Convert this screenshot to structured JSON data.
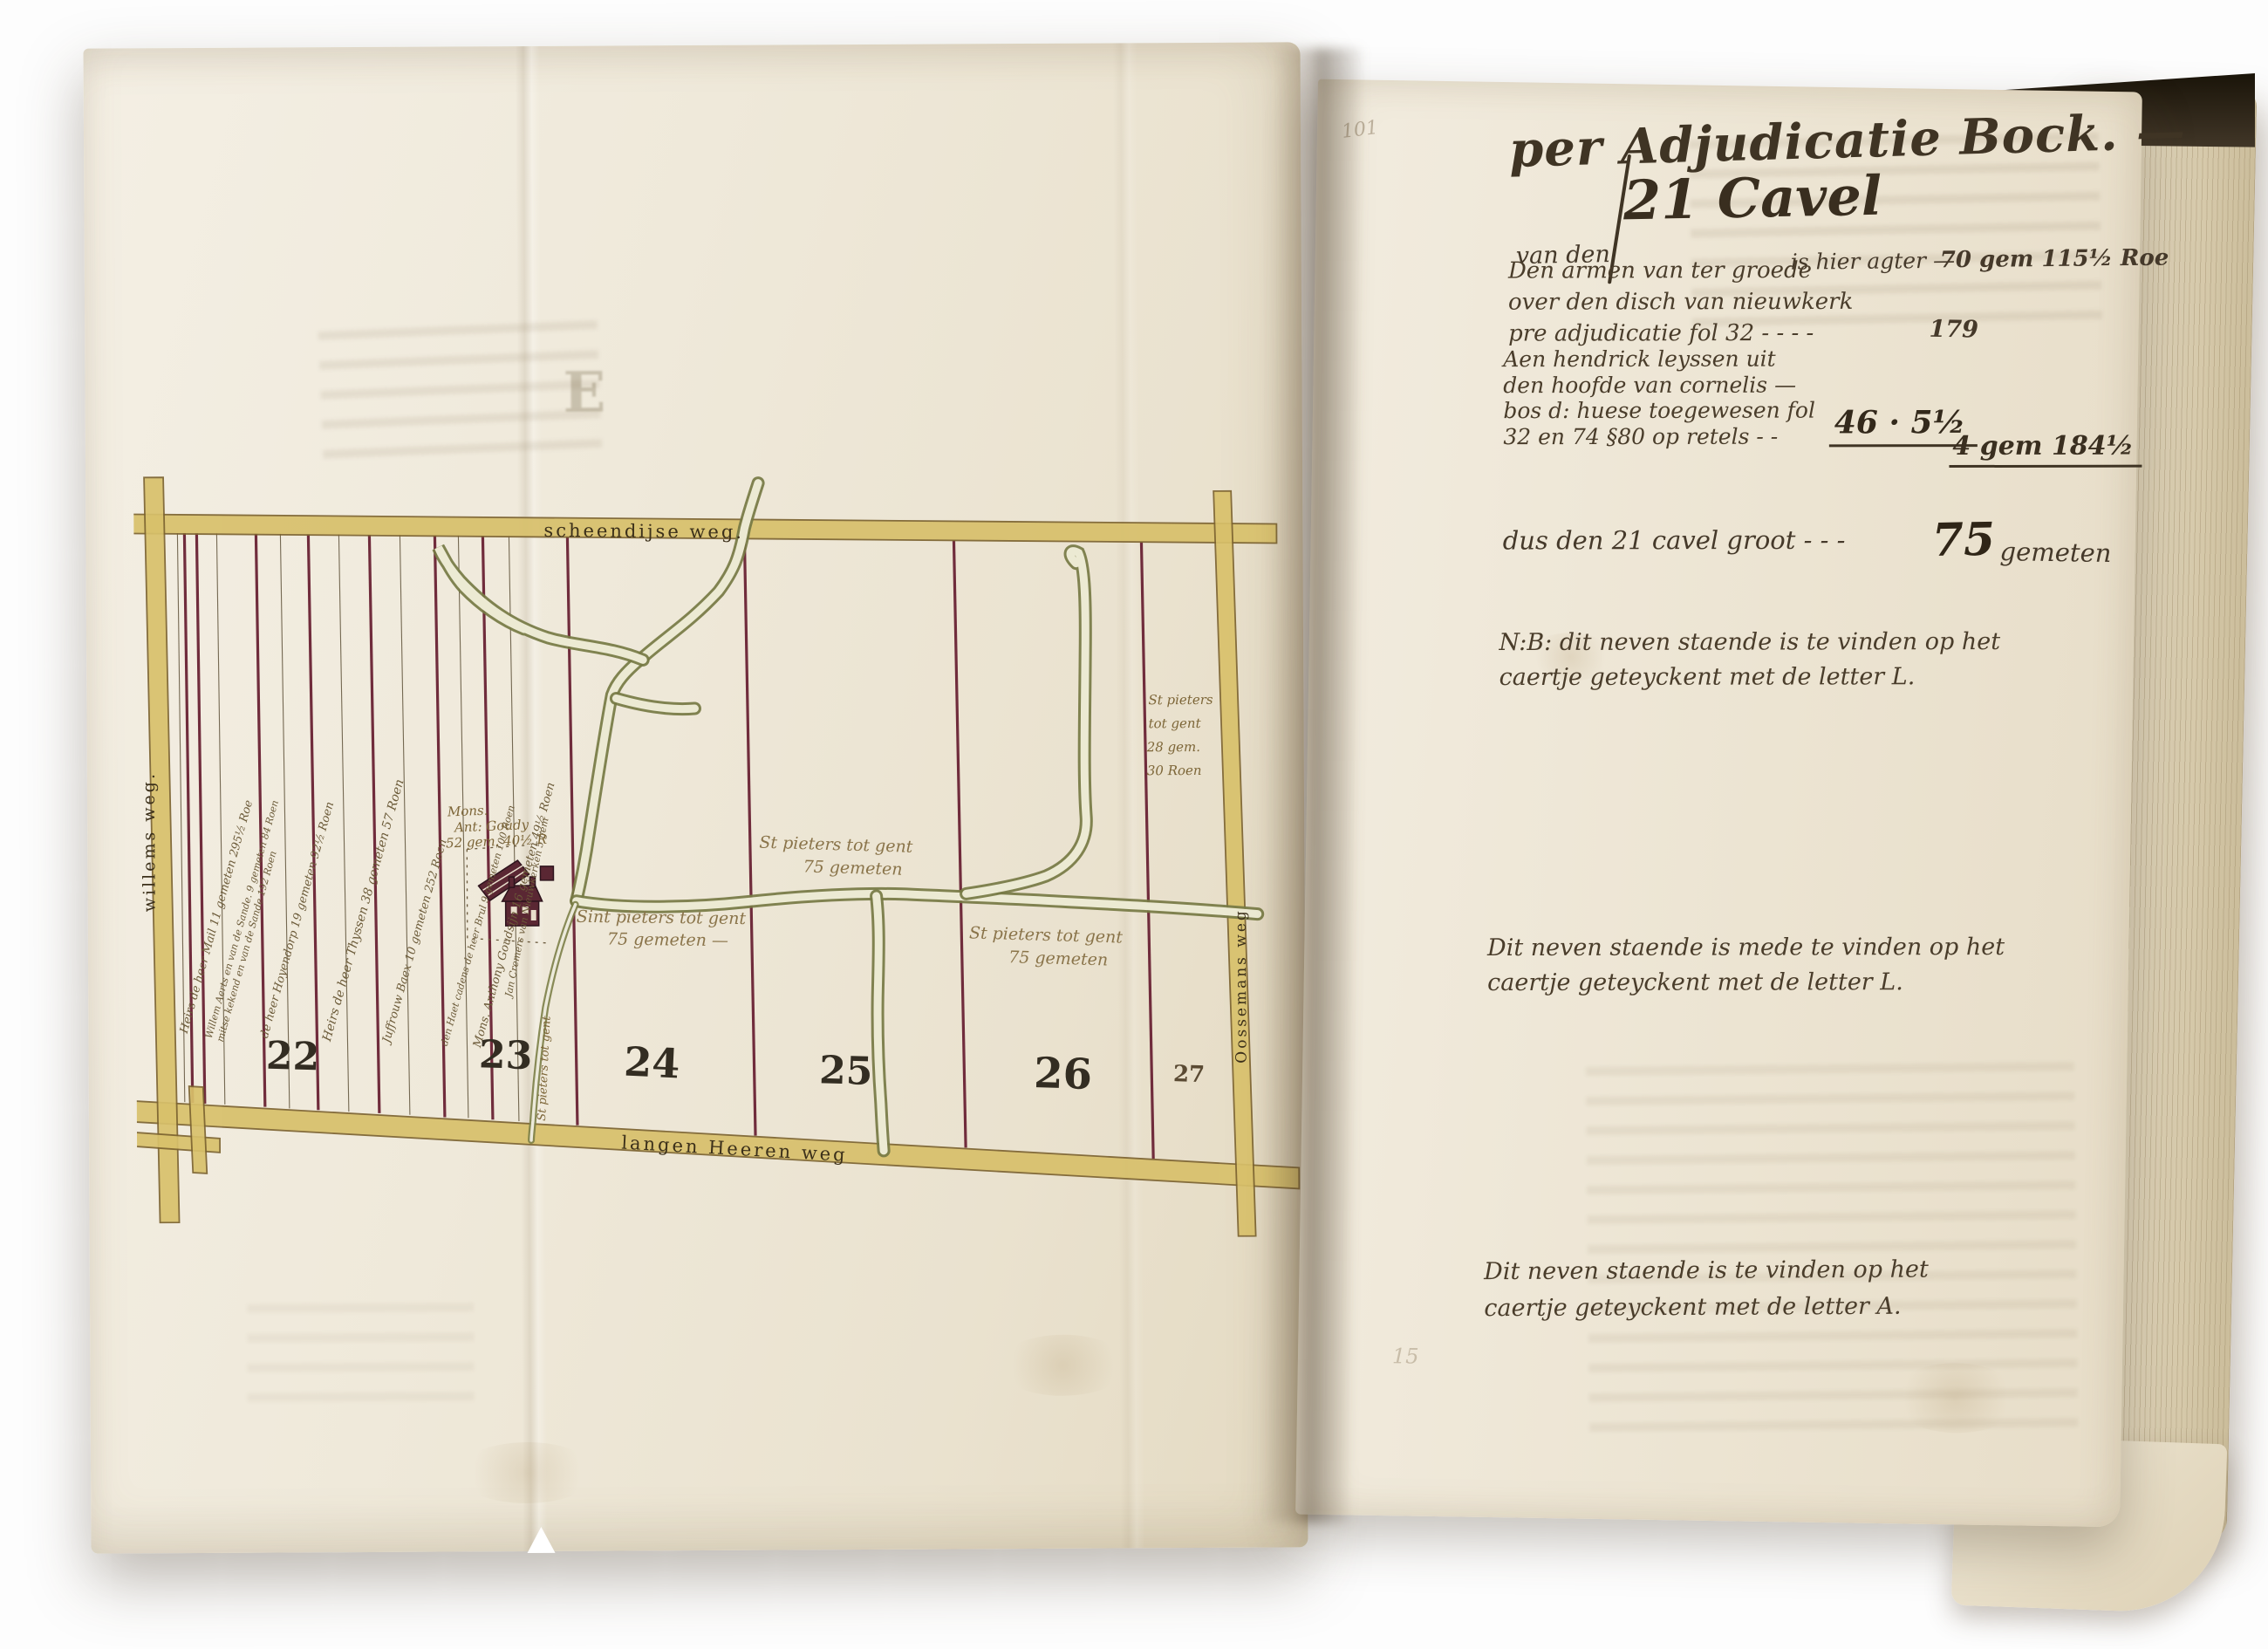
{
  "colors": {
    "background": "#ffffff",
    "parchment": "#f0e9da",
    "road_yellow": "#d8c06b",
    "parcel_line_maroon": "#702c3c",
    "creek_edge_green": "#767a44",
    "creek_fill": "#ecead3",
    "ink_dark_brown": "#3f3424",
    "ink_map_brown": "#7d6638",
    "farm_red": "#5a2733"
  },
  "book": {
    "left_page": {
      "ghost_letter": "E",
      "map": {
        "roads": {
          "top": "scheendijse weg.",
          "bottom": "langen Heeren weg",
          "left": "willems weg.",
          "right": "Oossemans weg"
        },
        "parcel_numbers": {
          "n22": "22",
          "n23": "23",
          "n24": "24",
          "n25": "25",
          "n26": "26",
          "n27": "27"
        },
        "strip_owners": [
          {
            "text": "Heirs de heer Mail 11 gemeten 295½ Roe"
          },
          {
            "text": "Willem Aerts en van de Sande. 9 gemeten 84 Roen"
          },
          {
            "text": "mitse kekend en van de Sande 192 Roen"
          },
          {
            "text": "de heer Hoyendorp 19 gemeten 92½ Roen"
          },
          {
            "text": "Heirs de heer Thyssen 38 gemeten 57 Roen"
          },
          {
            "text": "Juffrouw Baex 10 gemeten 252 Roen"
          },
          {
            "text": "den Haet cadens de heer Brul 9 gemeten 100 Roen"
          },
          {
            "text": "Mons. Anthony Goudsijn 16 gemeten 49½ Roen"
          },
          {
            "text": "Jan Cremers van Nieuwkerken 5 gem"
          }
        ],
        "labels": {
          "farm": {
            "line1": "Mons.",
            "line2": "Ant: Goudy",
            "line3": "52 gem. 40½ R"
          },
          "parcel24": {
            "line1": "Sint pieters tot gent",
            "line2": "75 gemeten —"
          },
          "parcel25": {
            "line1": "St pieters tot gent",
            "line2": "75 gemeten"
          },
          "parcel26": {
            "line1": "St pieters tot gent",
            "line2": "75 gemeten"
          },
          "parcel27": {
            "line1": "St pieters",
            "line2": "tot gent",
            "line3": "28 gem.",
            "line4": "30 Roen"
          },
          "ditch_vertical": "St pieters tot gent"
        }
      }
    },
    "right_page": {
      "page_number": "101",
      "title": "per Adjudicatie Bock. —",
      "subtitle": {
        "lead": "van den",
        "big": "21 Cavel",
        "rest": "is hier agter —",
        "value": "70 gem 115½ Roe"
      },
      "entry1": {
        "line1": "Den armen van ter groede",
        "line2": "over den disch van nieuwkerk",
        "line3": "pre adjudicatie fol 32 - - - -",
        "value": "179"
      },
      "entry2": {
        "line1": "Aen hendrick leyssen uit",
        "line2": "den hoofde van cornelis —",
        "line3": "bos d: huese toegewesen fol",
        "line4": "32 en 74 §80 op retels - -",
        "value": "46 · 5½",
        "value2": "4 gem 184½"
      },
      "total": {
        "text": "dus den 21 cavel groot - - -",
        "value_big": "75",
        "value_unit": "gemeten"
      },
      "note_nb": {
        "line1": "N:B: dit neven staende is te vinden op het",
        "line2": "caertje geteyckent met de letter L."
      },
      "note_mid": {
        "line1": "Dit neven staende is mede te vinden op het",
        "line2": "caertje geteyckent met de letter L."
      },
      "note_bottom": {
        "line1": "Dit neven staende is te vinden op het",
        "line2": "caertje geteyckent met de letter A."
      },
      "faint_number": "15"
    }
  }
}
